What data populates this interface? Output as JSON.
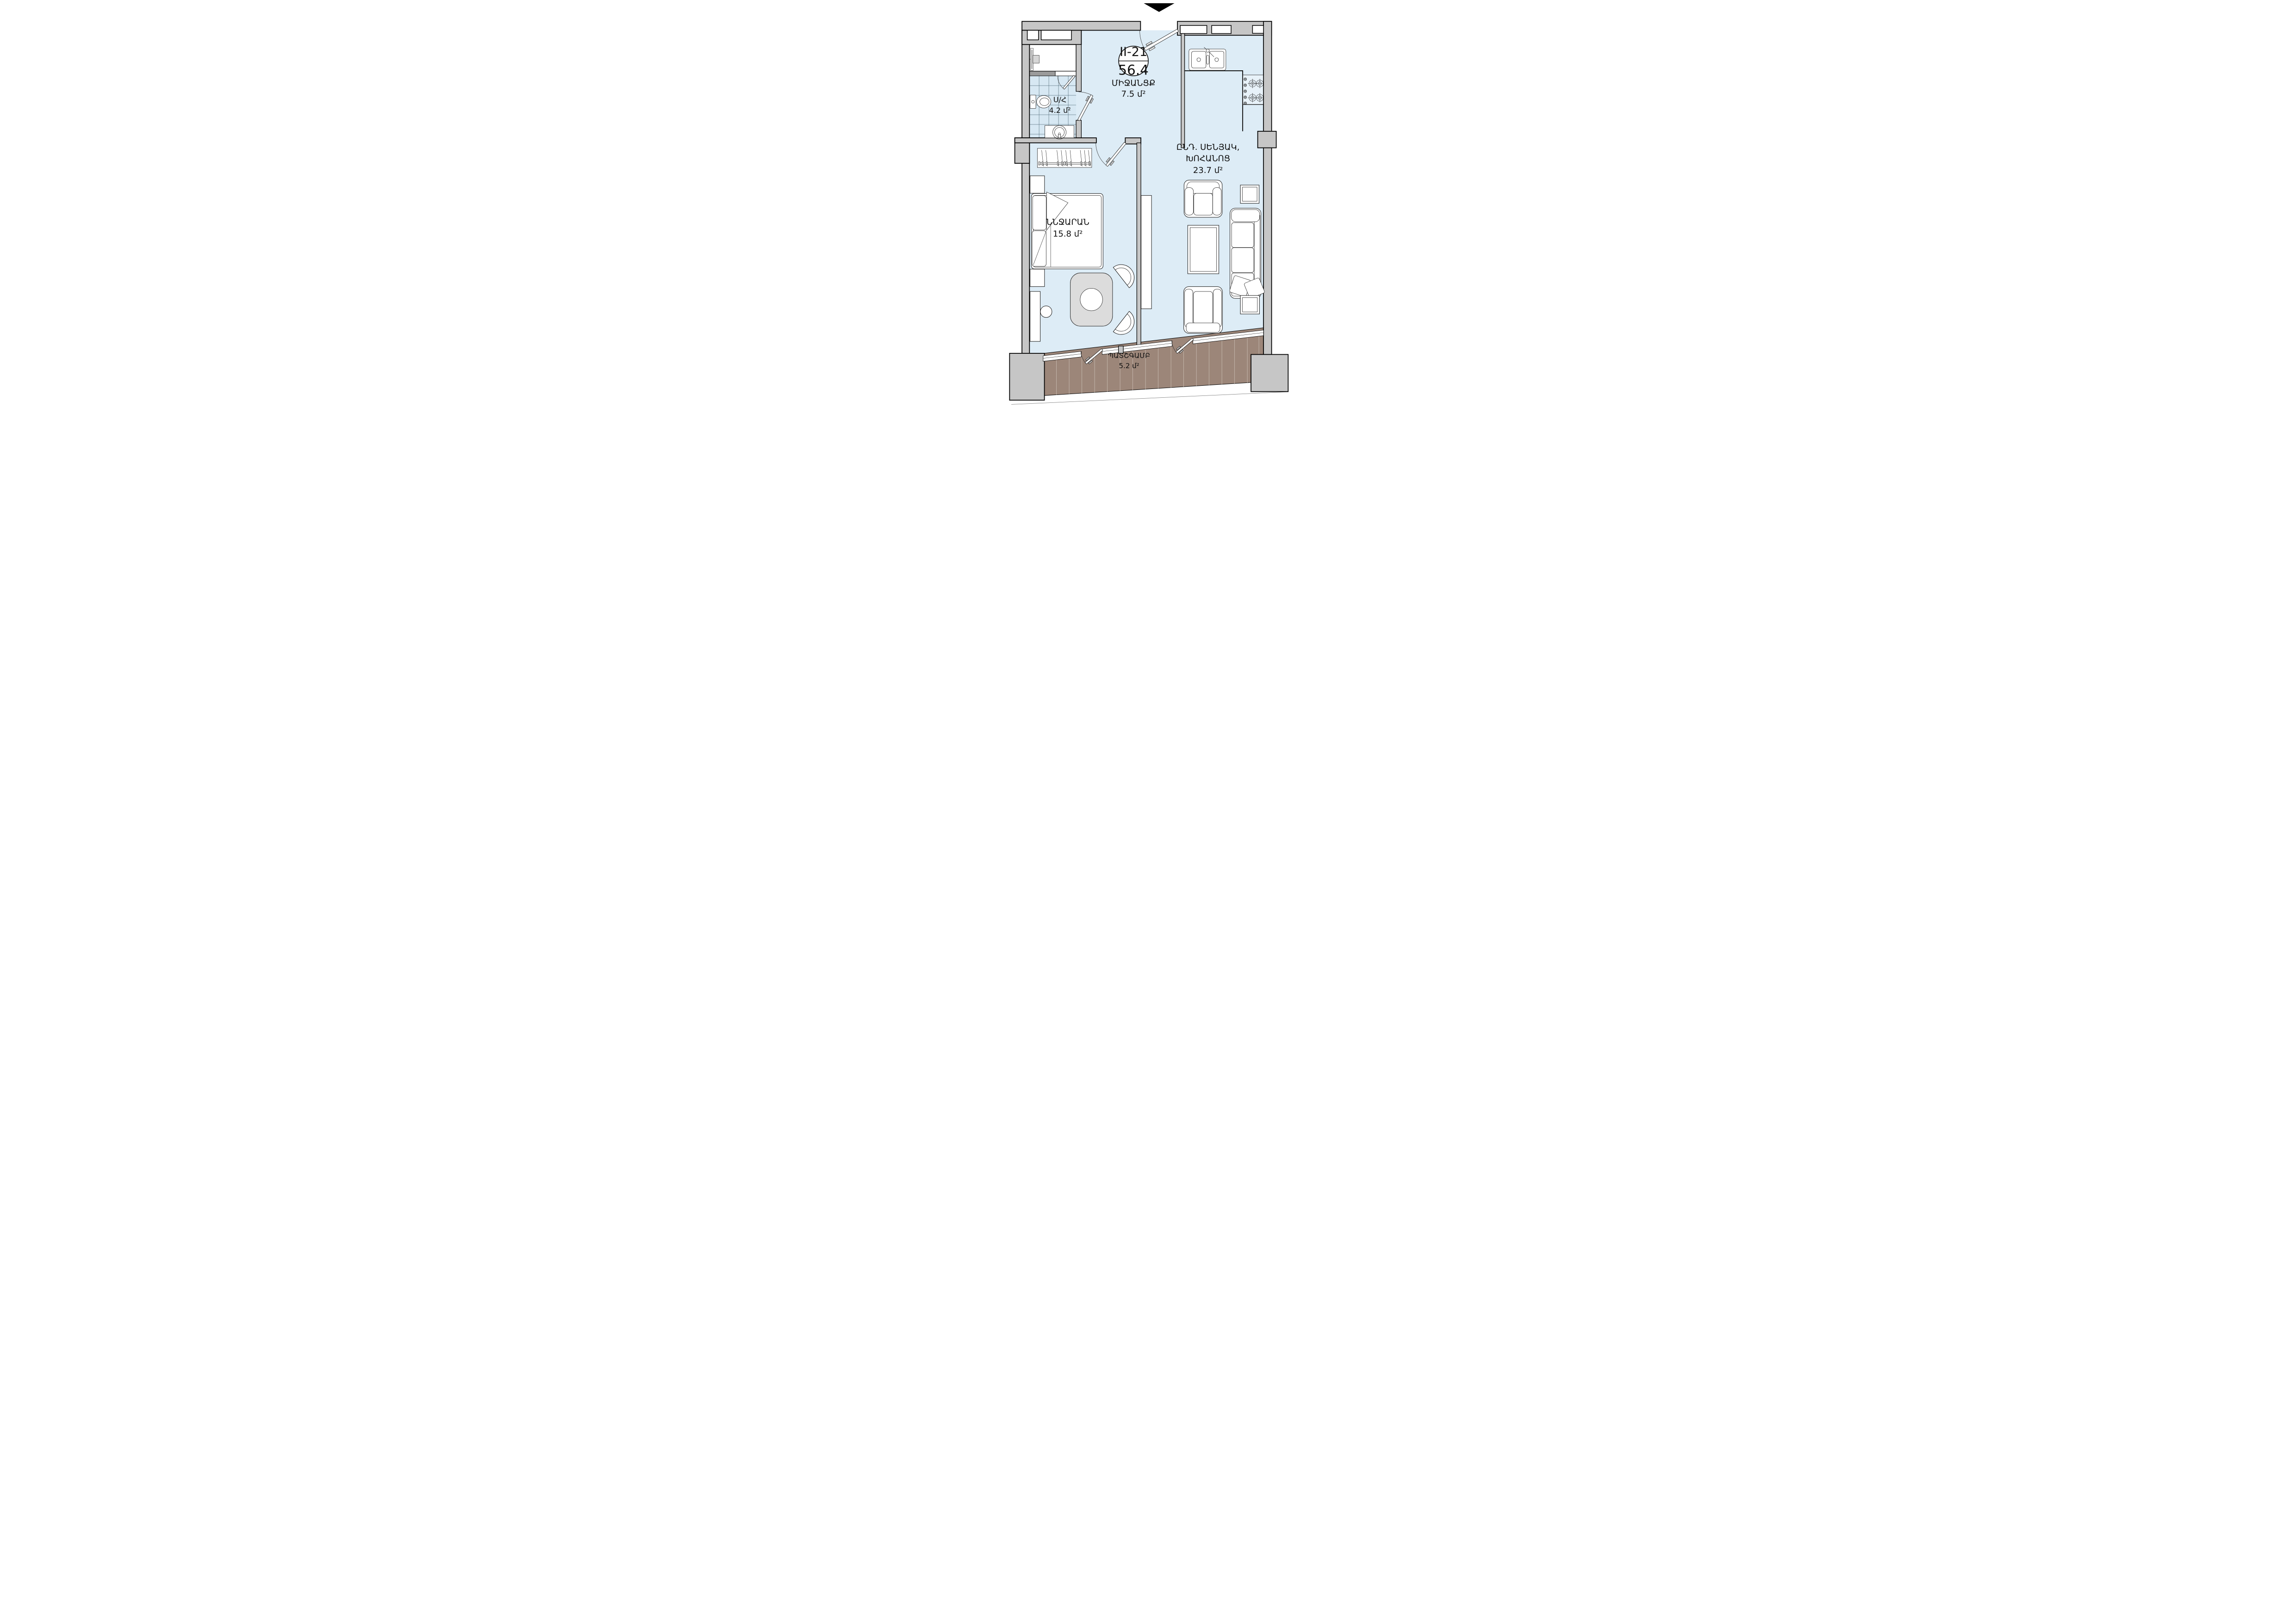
{
  "unit_badge": {
    "unit_id": "II-21",
    "total_area": "56.4"
  },
  "rooms": {
    "corridor": {
      "name": "ՄԻՋԱՆՑՔ",
      "area": "7.5 մ²"
    },
    "bathroom": {
      "name": "Ս/Հ",
      "area": "4.2 մ²"
    },
    "living_kitchen": {
      "name_line1": "ԸՆԴ. ՍԵՆՅԱԿ,",
      "name_line2": "ԽՈՀԱՆՈՑ",
      "area": "23.7 մ²"
    },
    "bedroom": {
      "name": "ՆՆՋԱՐԱՆ",
      "area": "15.8 մ²"
    },
    "balcony": {
      "name": "ՊԱՏՇԳԱՄԲ",
      "area": "5.2 մ²"
    }
  },
  "icons": {
    "entrance_marker": "entrance-arrow"
  },
  "colors": {
    "wall": "#c6c6c6",
    "floor": "#ddecf6",
    "tile_floor": "#d7e8f3",
    "shower_floor": "#ffffff",
    "balcony_floor": "#9c8679",
    "line": "#000000"
  }
}
